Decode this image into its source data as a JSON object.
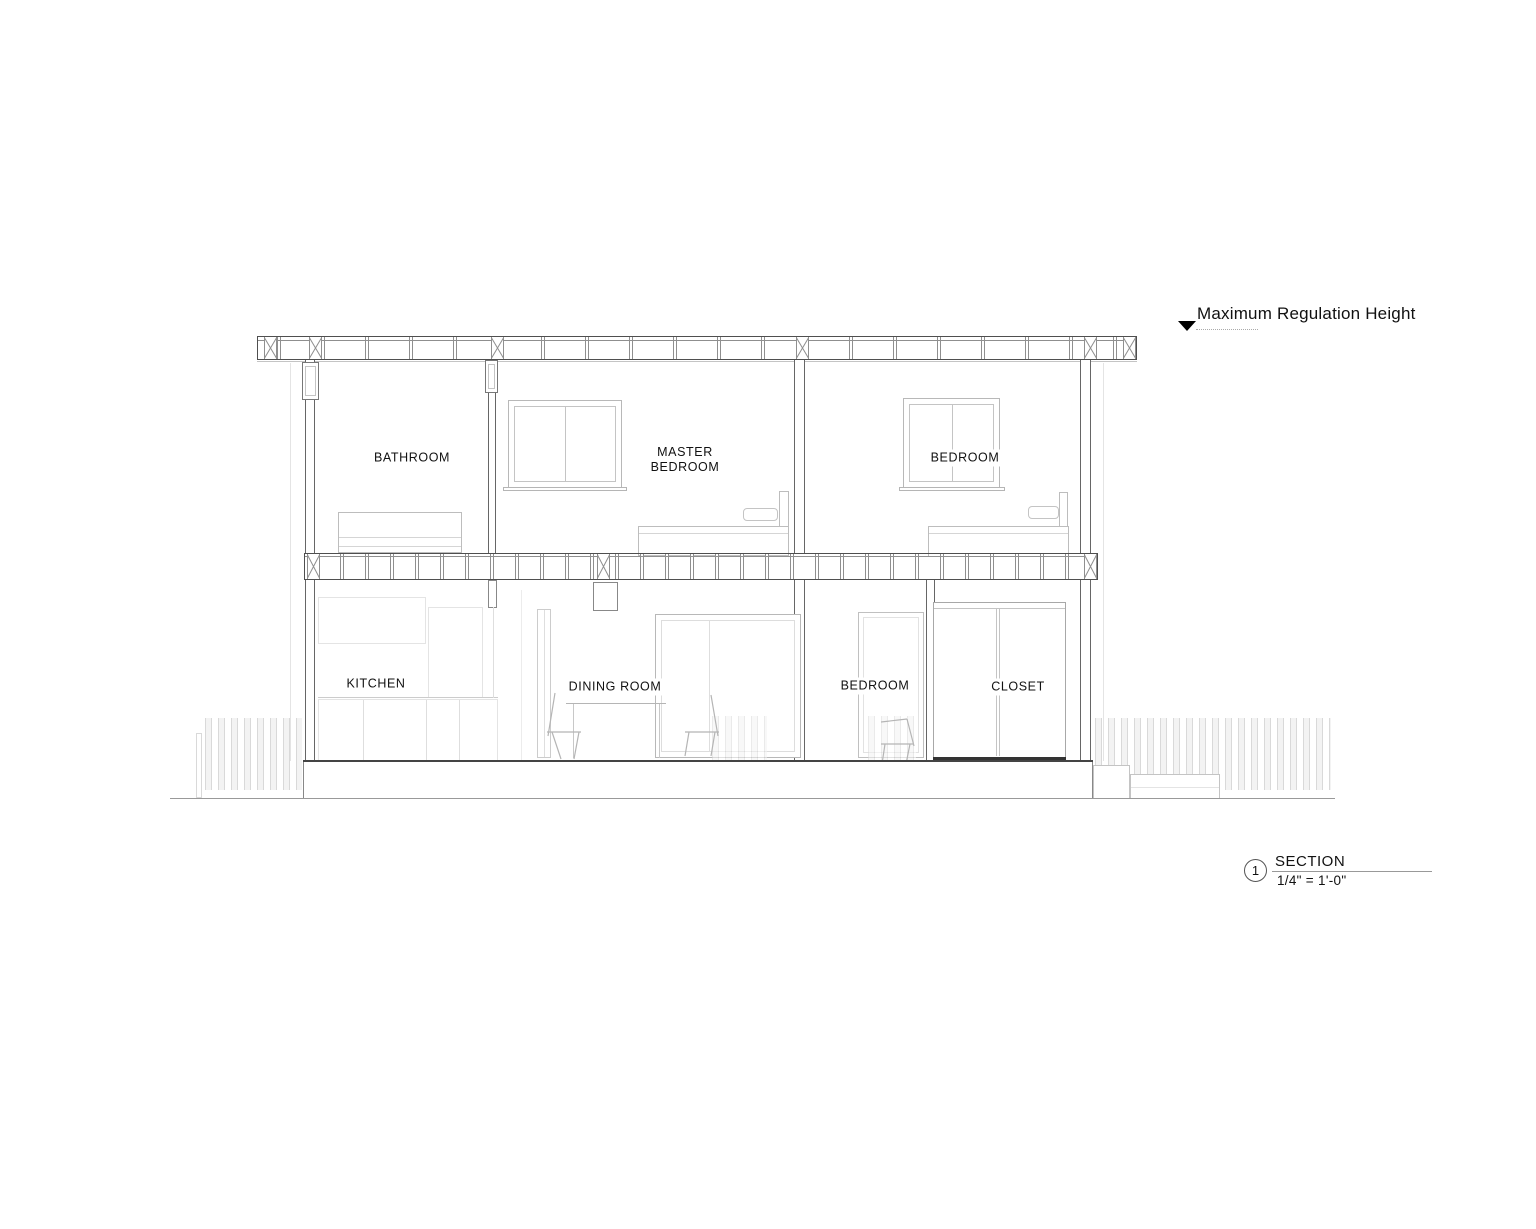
{
  "colors": {
    "line_dark": "#4f4f4f",
    "line_mid": "#8f8f8f",
    "line_light": "#c4c4c4",
    "line_faint": "#e4e4e4",
    "ink": "#111111",
    "fence": "#d9d9d9"
  },
  "annotations": {
    "max_height_label": "Maximum Regulation Height"
  },
  "rooms": {
    "upper": [
      {
        "id": "bathroom",
        "label": "BATHROOM"
      },
      {
        "id": "master-bedroom",
        "label": "MASTER\nBEDROOM"
      },
      {
        "id": "bedroom",
        "label": "BEDROOM"
      }
    ],
    "lower": [
      {
        "id": "kitchen",
        "label": "KITCHEN"
      },
      {
        "id": "dining-room",
        "label": "DINING ROOM"
      },
      {
        "id": "bedroom",
        "label": "BEDROOM"
      },
      {
        "id": "closet",
        "label": "CLOSET"
      }
    ]
  },
  "title_block": {
    "detail_number": "1",
    "view_name": "SECTION",
    "scale": "1/4\" = 1'-0\""
  }
}
